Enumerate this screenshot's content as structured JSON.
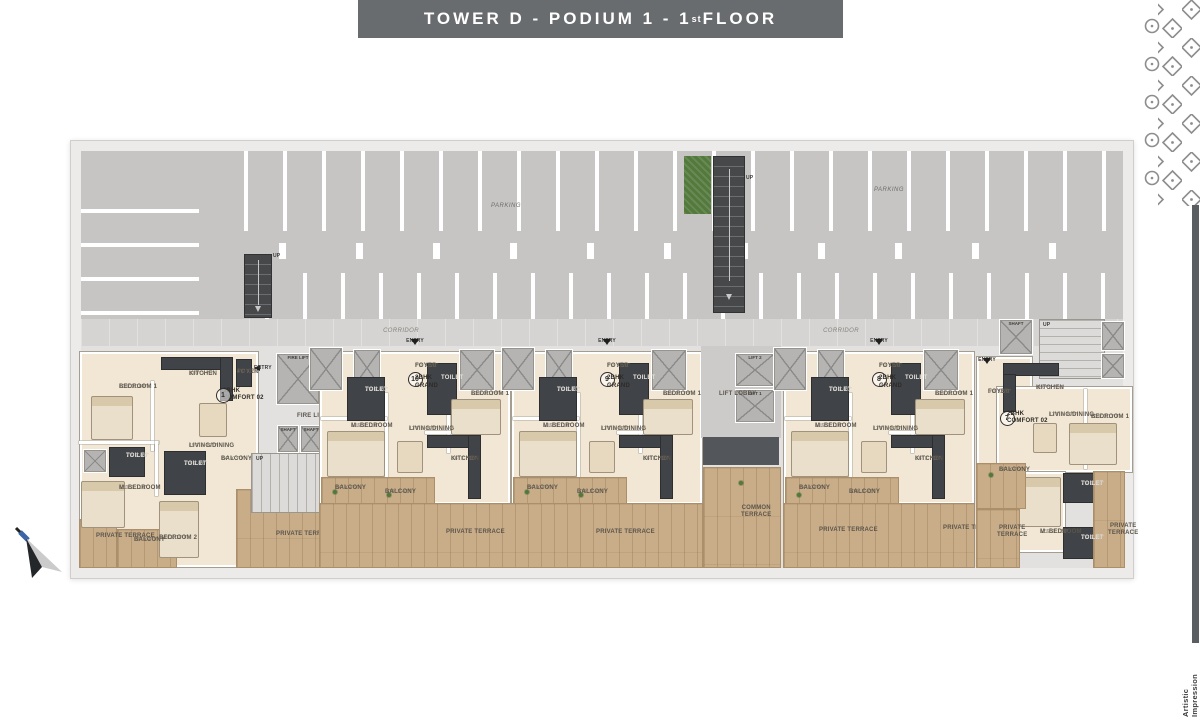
{
  "title": {
    "prefix": "TOWER D - PODIUM 1 - 1",
    "sup": "st",
    "suffix": " FLOOR"
  },
  "watermark": "Artistic Impression",
  "colors": {
    "title_bg": "#696c6e",
    "parking": "#c7c5c3",
    "unit_floor": "#f2e7d5",
    "terrace_wood": "#c9ad89",
    "dark_block": "#404347",
    "green_strip": "#53793c",
    "accent_bar": "#5a5e60"
  },
  "parking": {
    "label_left": "PARKING",
    "label_right": "PARKING",
    "up_left": "UP",
    "up_center": "UP"
  },
  "corridor": {
    "label_left": "CORRIDOR",
    "label_right": "CORRIDOR"
  },
  "core": {
    "entry_left": "ENTRY",
    "fire_lift": "FIRE LIFT",
    "fire_lift_lobby": "FIRE LIFT LOBBY",
    "shaft_a": "SHAFT",
    "shaft_b": "SHAFT",
    "stair_up": "UP",
    "terrace": "PRIVATE TERRACE",
    "lift_lobby": "LIFT LOBBY",
    "lift_1": "LIFT 1",
    "lift_2": "LIFT 2",
    "common_terrace": "COMMON TERRACE",
    "right_shaft": "SHAFT",
    "right_up": "UP"
  },
  "units": [
    {
      "badge": "1",
      "type": "3BHK",
      "variant": "COMFORT 02",
      "rooms": {
        "kitchen": {
          "name": "KITCHEN",
          "dim": "12'0\" X 7'7\""
        },
        "bedroom1": {
          "name": "BEDROOM 1",
          "dim": "10'0\" X 10'6\""
        },
        "foyer": {
          "name": "FOYER",
          "dim": "4'6\" X 7'7\""
        },
        "living": {
          "name": "LIVING/DINING",
          "dim": "19'0\" X 12'0\""
        },
        "toilet1": {
          "name": "TOILET",
          "dim": "7'6\" X 4'0\""
        },
        "mbedroom": {
          "name": "M. BEDROOM",
          "dim": "12'0\" X 11'0\""
        },
        "toilet2": {
          "name": "TOILET",
          "dim": "7'0\" X 4'6\""
        },
        "balcony1": {
          "name": "BALCONY",
          "dim": "7'4\" X 3'0\""
        },
        "bedroom2": {
          "name": "BEDROOM 2",
          "dim": "11'0\" X 10'0\""
        },
        "balcony2": {
          "name": "BALCONY",
          "dim": "2'0\" X 4'0\""
        },
        "terrace": {
          "name": "PRIVATE TERRACE"
        }
      }
    },
    {
      "badge": "10",
      "type": "2BHK",
      "variant": "GRAND",
      "rooms": {
        "entry": {
          "name": "ENTRY"
        },
        "foyer": {
          "name": "FOYER",
          "dim": "7'0\" X 5'0\""
        },
        "toilet1": {
          "name": "TOILET",
          "dim": "7'6\" X 4'0\""
        },
        "toilet2": {
          "name": "TOILET",
          "dim": "7'6\" X 4'0\""
        },
        "bedroom1": {
          "name": "BEDROOM 1",
          "dim": "10'0\" X 11'3\""
        },
        "mbedroom": {
          "name": "M. BEDROOM",
          "dim": "10'6\" X 11'0\""
        },
        "living": {
          "name": "LIVING/DINING",
          "dim": "17'6\" X 10'6\""
        },
        "kitchen": {
          "name": "KITCHEN",
          "dim": "8'6\" X 7'10\""
        },
        "balcony1": {
          "name": "BALCONY",
          "dim": "7'4\" X 4'6\""
        },
        "balcony2": {
          "name": "BALCONY",
          "dim": "5'10\" X 4'6\""
        },
        "terrace": {
          "name": "PRIVATE TERRACE"
        }
      }
    },
    {
      "badge": "9",
      "type": "2BHK",
      "variant": "GRAND",
      "rooms": {
        "entry": {
          "name": "ENTRY"
        },
        "foyer": {
          "name": "FOYER",
          "dim": "7'0\" X 5'0\""
        },
        "toilet1": {
          "name": "TOILET",
          "dim": "7'6\" X 4'0\""
        },
        "toilet2": {
          "name": "TOILET",
          "dim": "7'6\" X 4'0\""
        },
        "bedroom1": {
          "name": "BEDROOM 1",
          "dim": "10'0\" X 11'3\""
        },
        "mbedroom": {
          "name": "M. BEDROOM",
          "dim": "10'6\" X 11'0\""
        },
        "living": {
          "name": "LIVING/DINING",
          "dim": "17'6\" X 10'6\""
        },
        "kitchen": {
          "name": "KITCHEN",
          "dim": "8'6\" X 7'10\""
        },
        "balcony1": {
          "name": "BALCONY",
          "dim": "7'4\" X 4'6\""
        },
        "balcony2": {
          "name": "BALCONY",
          "dim": "5'10\" X 4'6\""
        },
        "terrace": {
          "name": "PRIVATE TERRACE"
        }
      }
    },
    {
      "badge": "8",
      "type": "2BHK",
      "variant": "GRAND",
      "rooms": {
        "entry": {
          "name": "ENTRY"
        },
        "foyer": {
          "name": "FOYER",
          "dim": "7'0\" X 5'0\""
        },
        "toilet1": {
          "name": "TOILET",
          "dim": "7'6\" X 4'0\""
        },
        "toilet2": {
          "name": "TOILET",
          "dim": "7'6\" X 4'0\""
        },
        "bedroom1": {
          "name": "BEDROOM 1",
          "dim": "10'0\" X 11'3\""
        },
        "mbedroom": {
          "name": "M. BEDROOM",
          "dim": "10'6\" X 11'0\""
        },
        "living": {
          "name": "LIVING/DINING",
          "dim": "17'6\" X 10'6\""
        },
        "kitchen": {
          "name": "KITCHEN",
          "dim": "8'6\" X 7'10\""
        },
        "balcony1": {
          "name": "BALCONY",
          "dim": "7'4\" X 4'6\""
        },
        "balcony2": {
          "name": "BALCONY",
          "dim": "5'10\" X 4'6\""
        },
        "terrace": {
          "name": "PRIVATE TERRACE"
        },
        "terrace2": {
          "name": "PRIVATE TERRACE"
        }
      }
    },
    {
      "badge": "7",
      "type": "2BHK",
      "variant": "COMFORT 02",
      "rooms": {
        "entry": {
          "name": "ENTRY"
        },
        "foyer": {
          "name": "FOYER",
          "dim": "5'0\" X 5'0\""
        },
        "kitchen": {
          "name": "KITCHEN",
          "dim": "11'0\" X 7'10\""
        },
        "living": {
          "name": "LIVING/DINING",
          "dim": "17'6\" X 10'6\""
        },
        "bedroom1": {
          "name": "BEDROOM 1",
          "dim": "10'0\" X 11'0\""
        },
        "balcony1": {
          "name": "BALCONY",
          "dim": "7'4\" X 4'6\""
        },
        "mbedroom": {
          "name": "M. BEDROOM",
          "dim": "12'6\" X 12'0\""
        },
        "toilet1": {
          "name": "TOILET",
          "dim": "7'6\" X 4'0\""
        },
        "toilet2": {
          "name": "TOILET",
          "dim": "7'6\" X 4'0\""
        },
        "terrace1": {
          "name": "PRIVATE TERRACE"
        },
        "terrace2": {
          "name": "PRIVATE TERRACE"
        }
      }
    }
  ]
}
